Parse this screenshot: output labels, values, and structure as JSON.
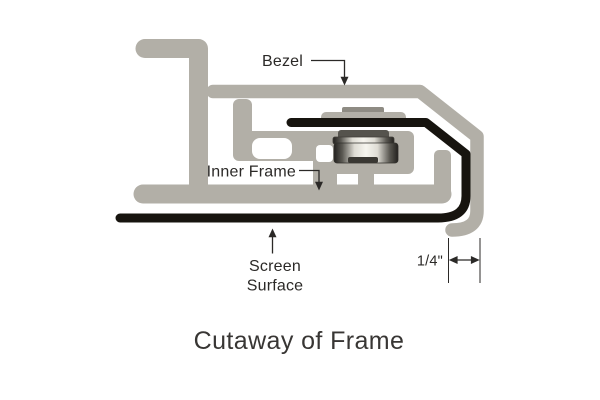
{
  "diagram": {
    "caption": "Cutaway of Frame",
    "labels": {
      "bezel": "Bezel",
      "inner_frame": "Inner Frame",
      "screen_surface": {
        "line1": "Screen",
        "line2": "Surface"
      },
      "dimension": "1/4\""
    },
    "colors": {
      "aluminum": "#b2afa7",
      "aluminum_dark": "#8e8b83",
      "screen_black": "#17140f",
      "annotation": "#2b2927",
      "background": "#ffffff"
    }
  }
}
